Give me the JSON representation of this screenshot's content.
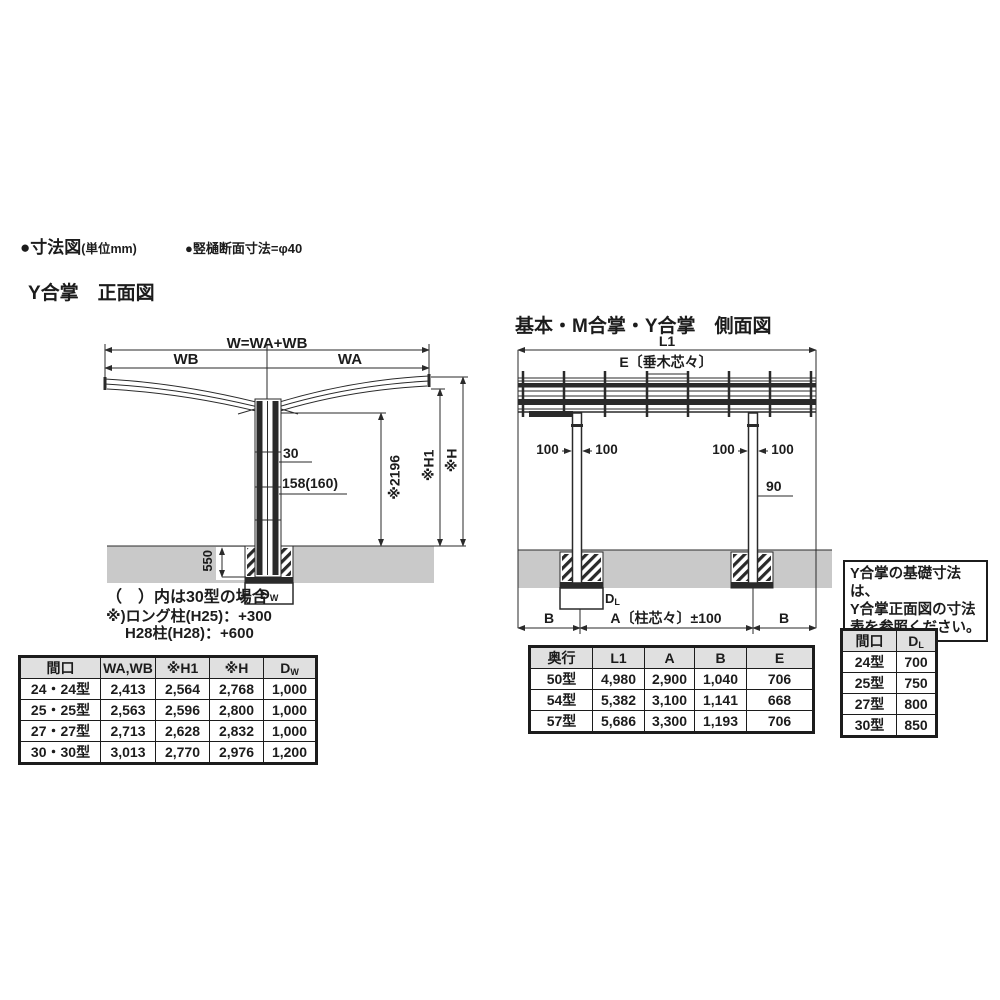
{
  "header": {
    "bullet1_main": "●寸法図",
    "bullet1_unit": "(単位mm)",
    "bullet2": "●竪樋断面寸法=φ40"
  },
  "front_view": {
    "title": "Y合掌　正面図",
    "labels": {
      "w_total": "W=WA+WB",
      "wb": "WB",
      "wa": "WA",
      "offset30": "30",
      "post158": "158(160)",
      "clear2196": "※2196",
      "h1": "※H1",
      "h": "※H",
      "embed550": "550",
      "footing_main": "D",
      "footing_sub": "W"
    },
    "notes": [
      "（　）内は30型の場合",
      "※)ロング柱(H25)：+300",
      "H28柱(H28)：+600"
    ],
    "table": {
      "col_maguchi": "間口",
      "col_wawb": "WA,WB",
      "col_h1": "※H1",
      "col_h": "※H",
      "col_d_main": "D",
      "col_d_sub": "W",
      "rows": [
        [
          "24・24型",
          "2,413",
          "2,564",
          "2,768",
          "1,000"
        ],
        [
          "25・25型",
          "2,563",
          "2,596",
          "2,800",
          "1,000"
        ],
        [
          "27・27型",
          "2,713",
          "2,628",
          "2,832",
          "1,000"
        ],
        [
          "30・30型",
          "3,013",
          "2,770",
          "2,976",
          "1,200"
        ]
      ]
    }
  },
  "side_view": {
    "title": "基本・M合掌・Y合掌　側面図",
    "labels": {
      "l1": "L1",
      "e": "E〔垂木芯々〕",
      "offset100": "100",
      "post90": "90",
      "b": "B",
      "a": "A〔柱芯々〕±100",
      "footing_main": "D",
      "footing_sub": "L"
    },
    "table": {
      "col_okuyuki": "奥行",
      "col_l1": "L1",
      "col_a": "A",
      "col_b": "B",
      "col_e": "E",
      "rows": [
        [
          "50型",
          "4,980",
          "2,900",
          "1,040",
          "706"
        ],
        [
          "54型",
          "5,382",
          "3,100",
          "1,141",
          "668"
        ],
        [
          "57型",
          "5,686",
          "3,300",
          "1,193",
          "706"
        ]
      ]
    }
  },
  "note_box": {
    "lines": [
      "Y合掌の基礎寸法は、",
      "Y合掌正面図の寸法",
      "表を参照ください。"
    ]
  },
  "footing_table": {
    "col_maguchi": "間口",
    "col_d_main": "D",
    "col_d_sub": "L",
    "rows": [
      [
        "24型",
        "700"
      ],
      [
        "25型",
        "750"
      ],
      [
        "27型",
        "800"
      ],
      [
        "30型",
        "850"
      ]
    ]
  },
  "colors": {
    "line": "#2a2a2a",
    "ground": "#c9c9c9",
    "table_header_bg": "#e0e0e0"
  }
}
